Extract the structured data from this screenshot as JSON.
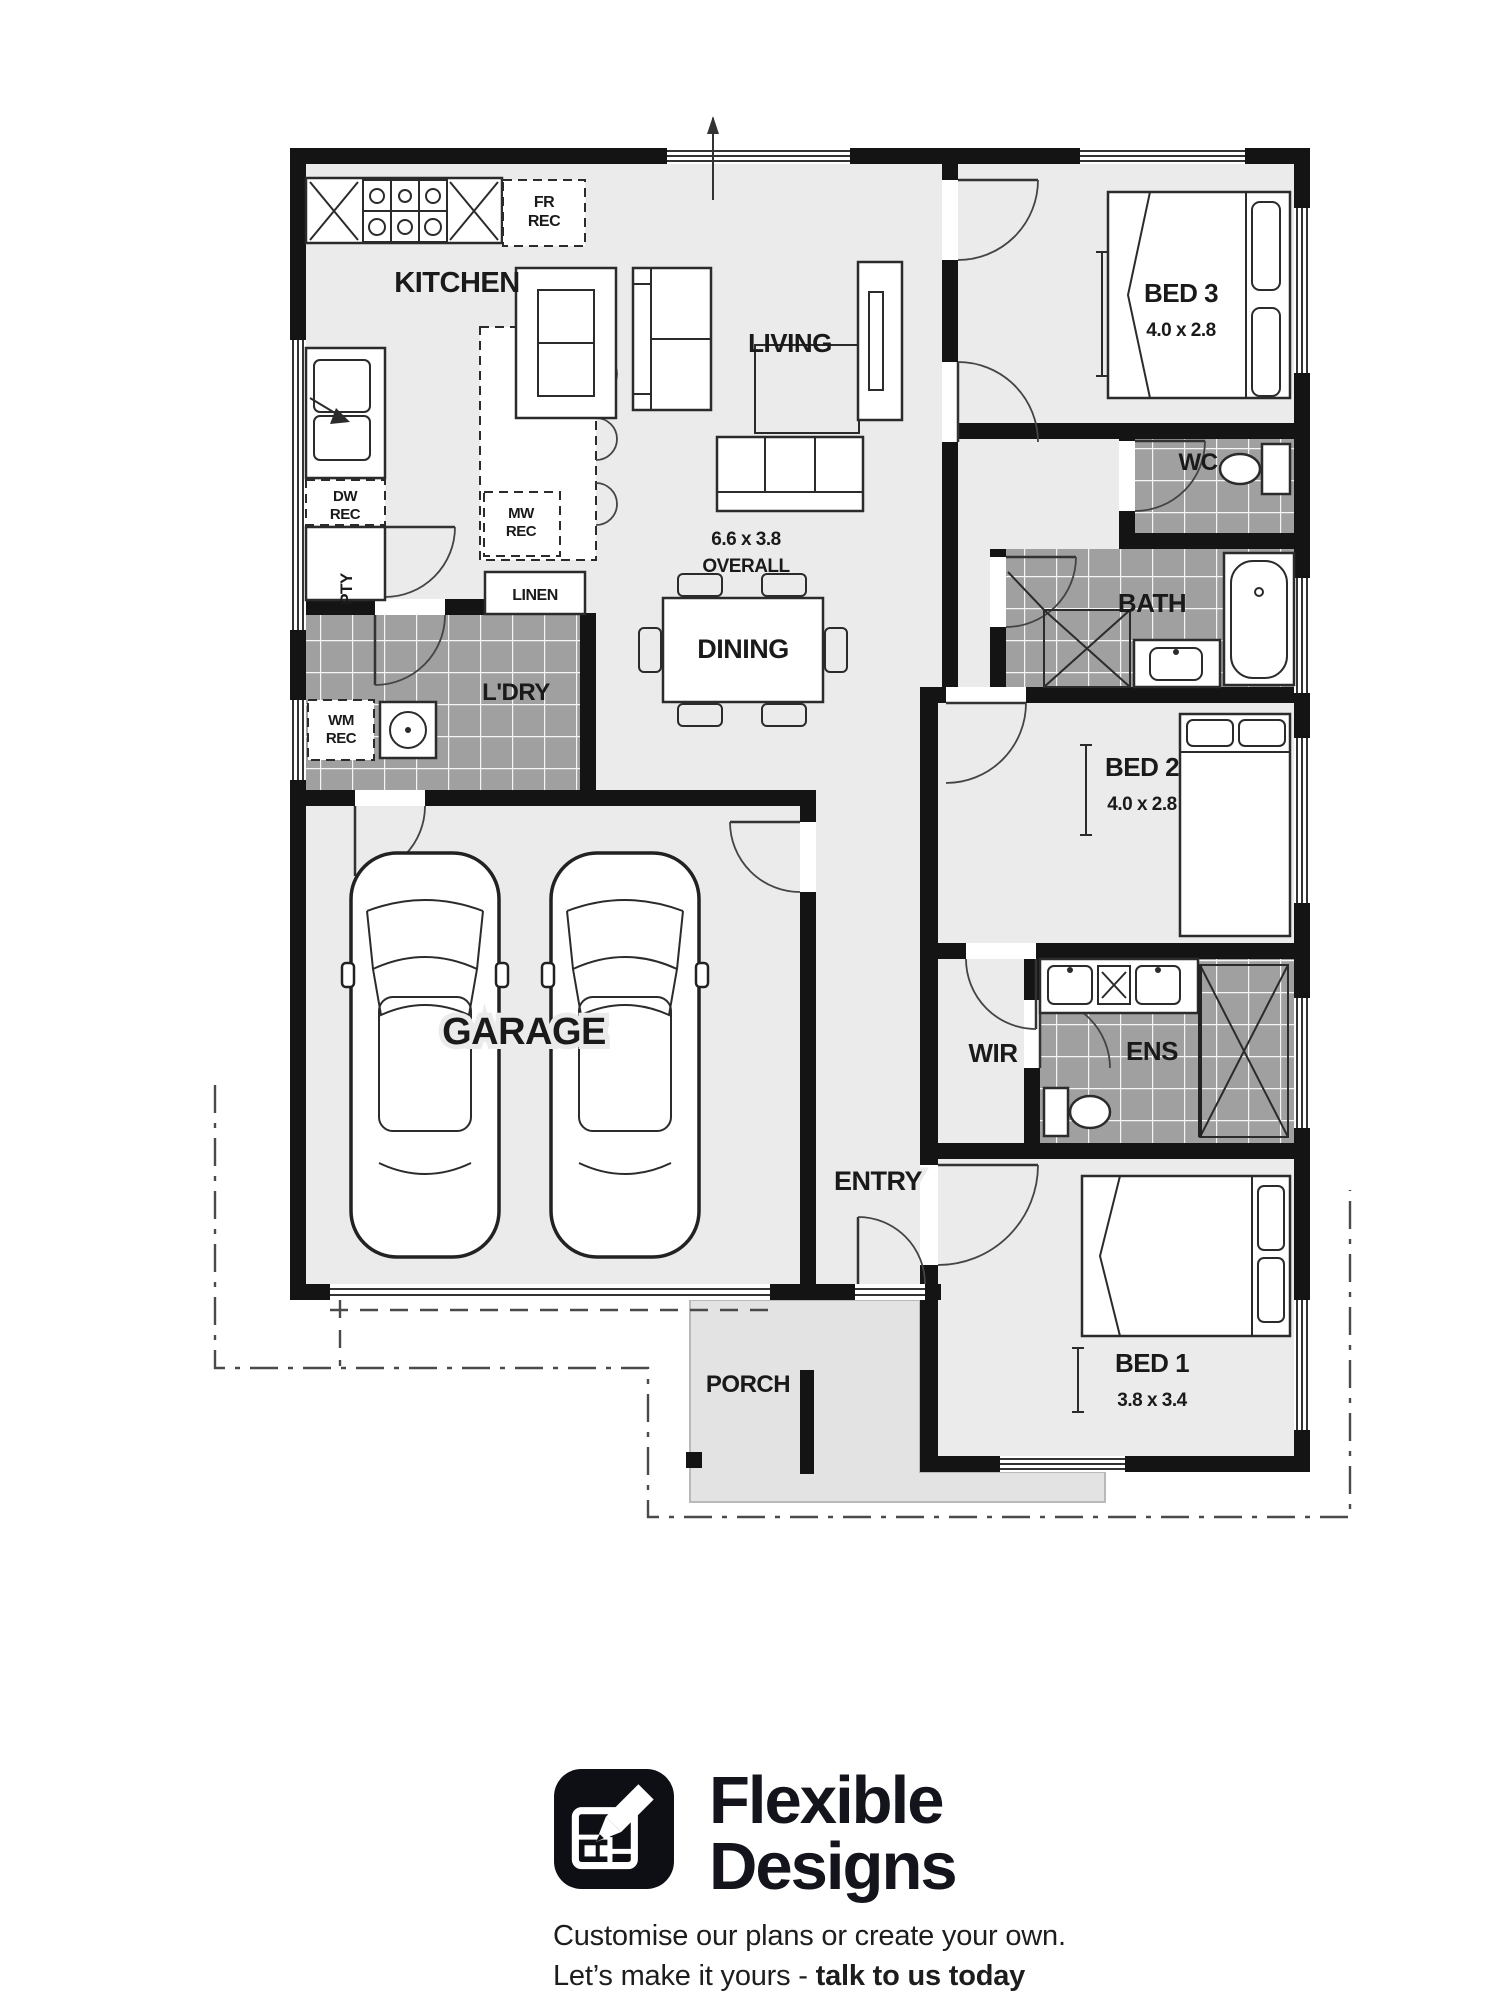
{
  "plan": {
    "labels": {
      "kitchen": "KITCHEN",
      "living": "LIVING",
      "dining": "DINING",
      "overall1": "6.6 x 3.8",
      "overall2": "OVERALL",
      "bed3": "BED 3",
      "bed3_dims": "4.0 x 2.8",
      "bed2": "BED 2",
      "bed2_dims": "4.0 x 2.8",
      "bed1": "BED 1",
      "bed1_dims": "3.8 x 3.4",
      "wc": "WC",
      "bath": "BATH",
      "ens": "ENS",
      "wir": "WIR",
      "ldry": "L'DRY",
      "linen": "LINEN",
      "garage": "GARAGE",
      "entry": "ENTRY",
      "porch": "PORCH",
      "pty": "PTY",
      "fr_rec": [
        "FR",
        "REC"
      ],
      "dw_rec": [
        "DW",
        "REC"
      ],
      "mw_rec": [
        "MW",
        "REC"
      ],
      "wm_rec": [
        "WM",
        "REC"
      ]
    },
    "colors": {
      "wall": "#141414",
      "floor": "#ebebeb",
      "tile": "#a0a0a0",
      "grout": "#f5f5f5",
      "porch": "#e3e3e3",
      "line": "#2b2b2b",
      "text": "#1a1a1a"
    }
  },
  "branding": {
    "name1": "Flexible",
    "name2": "Designs",
    "tagline1": "Customise our plans or create your own.",
    "tagline2_prefix": "Let’s make it yours - ",
    "tagline2_bold": "talk to us today"
  }
}
